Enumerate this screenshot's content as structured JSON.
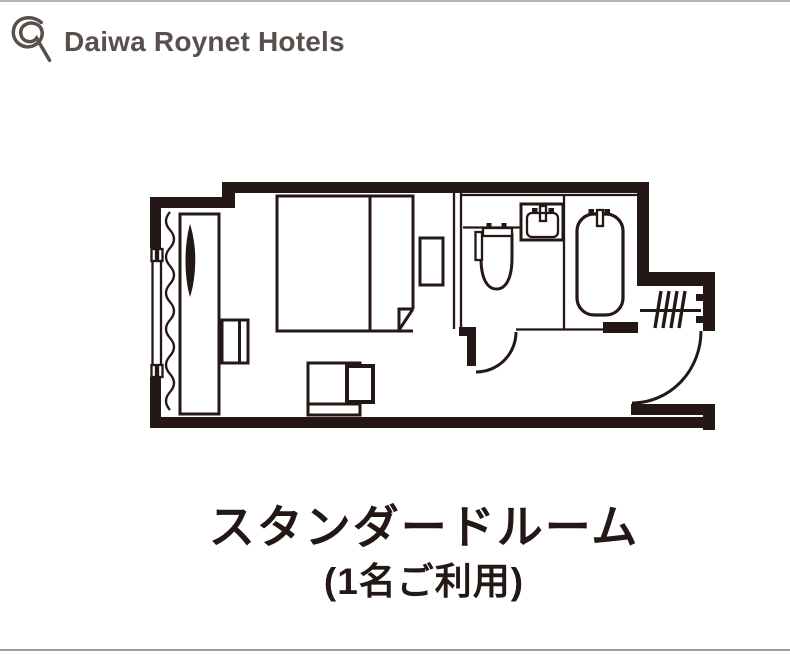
{
  "header": {
    "brand": "Daiwa Roynet Hotels"
  },
  "caption": {
    "title": "スタンダードルーム",
    "subtitle": "(1名ご利用)"
  },
  "floorplan": {
    "name": "standard-room-floor-plan",
    "fixtures": [
      "window",
      "curtain",
      "desk",
      "tv",
      "stool",
      "bed",
      "pillow-divider",
      "sheet-fold",
      "nightstand",
      "lounge-chair",
      "side-table",
      "toilet",
      "washbasin",
      "bathtub",
      "bathroom-door",
      "entrance-door",
      "hanger-rack",
      "entrance-step"
    ]
  },
  "colors": {
    "line": "#231815",
    "logo": "#57504d",
    "top_rule": "#b3b3b3",
    "bottom_rule": "#9e9e9e",
    "background": "#ffffff"
  }
}
